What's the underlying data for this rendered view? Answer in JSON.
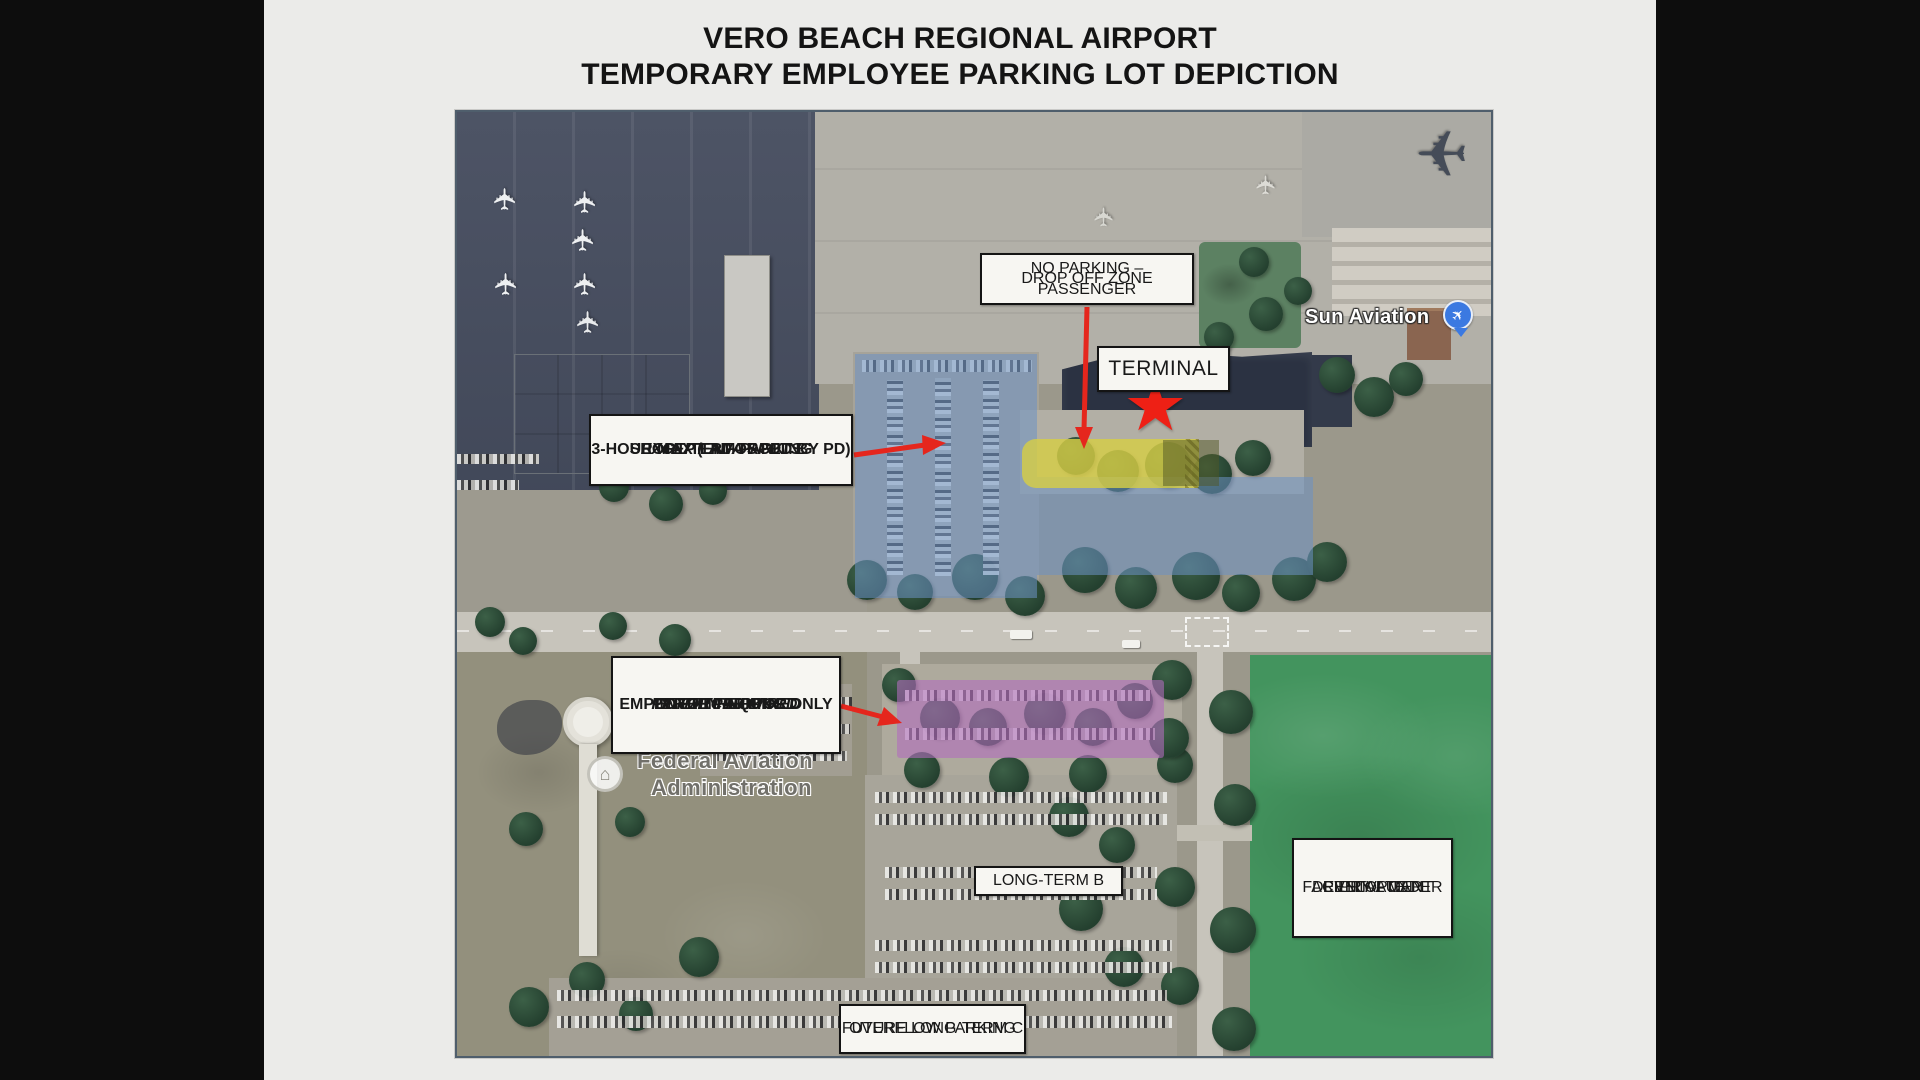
{
  "title": {
    "line1": "VERO BEACH REGIONAL AIRPORT",
    "line2": "TEMPORARY EMPLOYEE PARKING LOT DEPICTION"
  },
  "map_labels": {
    "no_parking": {
      "line1": "NO PARKING – PASSENGER",
      "line2": "DROP OFF ZONE"
    },
    "terminal": {
      "label": "TERMINAL"
    },
    "short_term": {
      "line1": "SHORT-TERM PARKING",
      "line2": "3-HOUR MAX (ENFORCED BY PD)",
      "line3": "EXCEPT ADA SPOTS"
    },
    "interim": {
      "line1": "INTERIM AIRPORT",
      "line2": "EMPLOYEE PARKING ONLY",
      "line3": "PERMIT REQUIRED",
      "line4": "ENFORCED BY PD"
    },
    "long_term_b": {
      "label": "LONG-TERM B"
    },
    "rental_car": {
      "line1": "RENTAL CAR",
      "line2": "FACILITY - UNDER",
      "line3": "PRIVATE",
      "line4": "DEVELOPMENT"
    },
    "overflow": {
      "line1": "OVERFLOW PARKING",
      "line2": "FUTURE LONG-TERM C"
    }
  },
  "map_texts": {
    "sun_aviation": "Sun Aviation",
    "faa_line1": "Federal Aviation",
    "faa_line2": "Administration"
  },
  "glyphs": {
    "airplane": "✈",
    "star": "★",
    "building": "⌂"
  },
  "colors": {
    "red_arrow": "#e5261d",
    "star_red": "#ee2015",
    "overlay_blue": "#6c92c4",
    "overlay_yellow": "#d6cd46",
    "overlay_purple": "#b06cbc",
    "field_green": "#43945e",
    "apron_dark": "#464d5f",
    "label_bg": "#f7f6f2",
    "label_border": "#141414"
  }
}
